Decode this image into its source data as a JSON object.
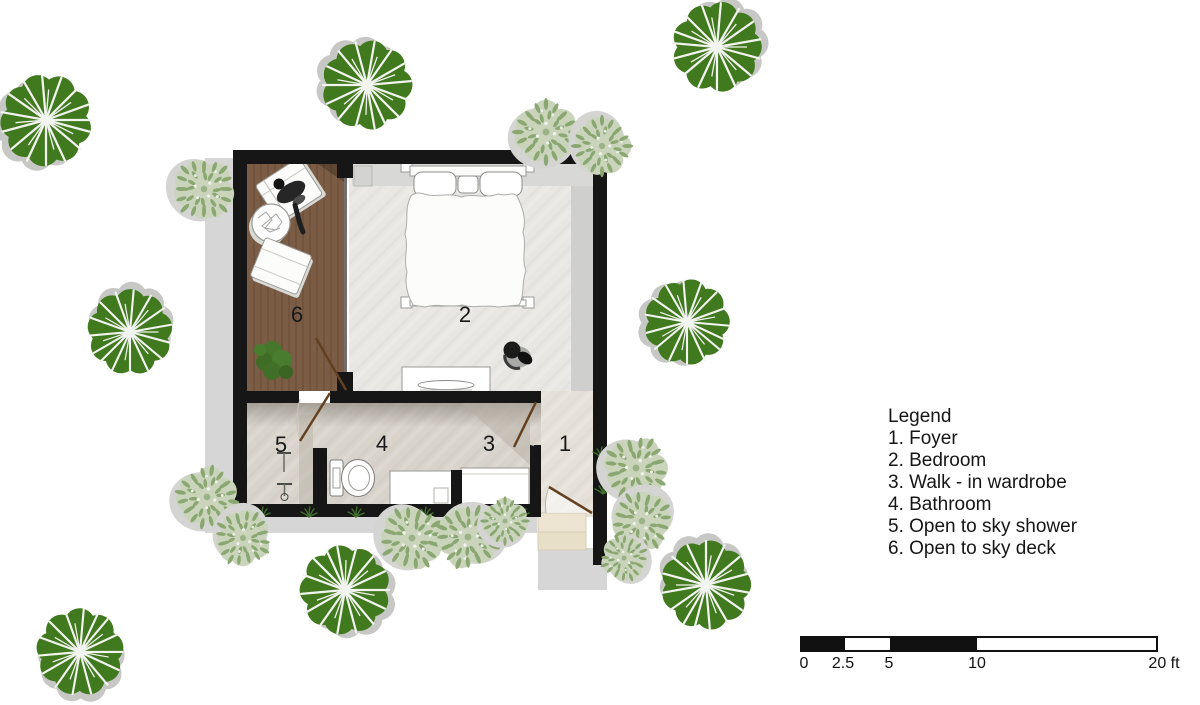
{
  "plan": {
    "rooms": [
      {
        "number": "1",
        "label": "Foyer"
      },
      {
        "number": "2",
        "label": "Bedroom"
      },
      {
        "number": "3",
        "label": "Walk - in wardrobe"
      },
      {
        "number": "4",
        "label": "Bathroom"
      },
      {
        "number": "5",
        "label": "Open to sky shower"
      },
      {
        "number": "6",
        "label": "Open to sky deck"
      }
    ]
  },
  "legend": {
    "title": "Legend",
    "items": [
      "1. Foyer",
      "2. Bedroom",
      "3. Walk - in wardrobe",
      "4. Bathroom",
      "5. Open to sky shower",
      "6. Open to sky deck"
    ]
  },
  "scale_bar": {
    "labels": [
      "0",
      "2.5",
      "5",
      "10",
      "20 ft"
    ],
    "unit": "ft"
  },
  "colors": {
    "wall": "#161616",
    "tree_green": "#41791f",
    "shrub_green": "#c9d4bb",
    "deck_wood": "#7b5d45",
    "door_brown": "#63401f",
    "bedroom_floor": "#e8e7e3",
    "bath_floor": "#d8d3cb",
    "shadow_gray": "#d6d6d6"
  }
}
